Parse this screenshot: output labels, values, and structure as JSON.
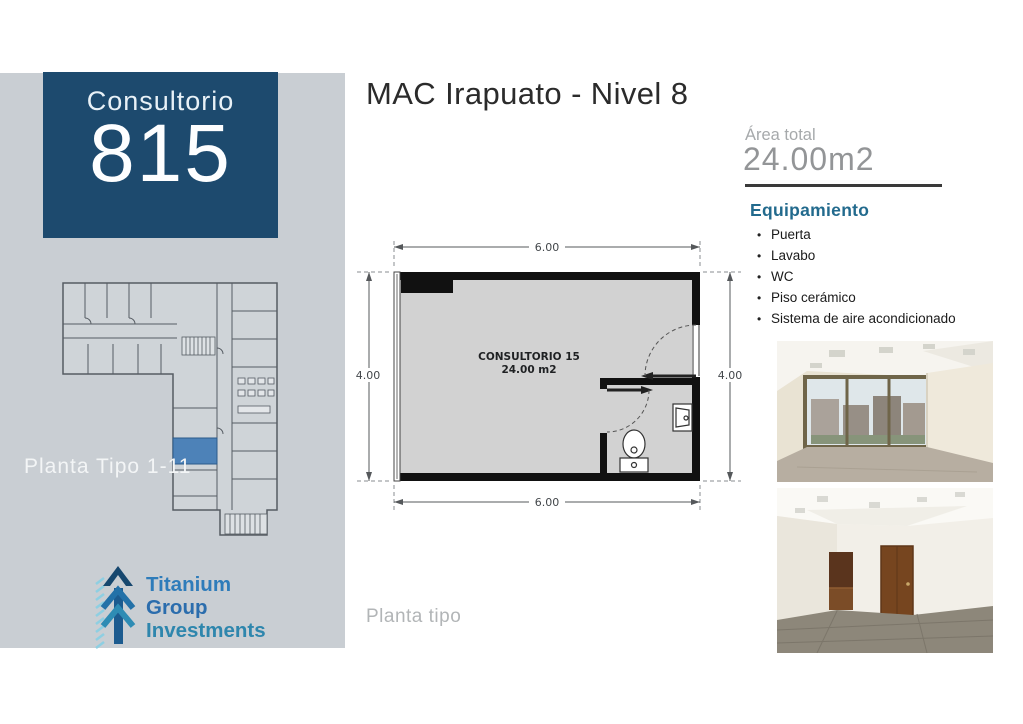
{
  "sidebar": {
    "bg_color": "#c9ced3",
    "unit_box": {
      "bg_color": "#1d4a6e",
      "label": "Consultorio",
      "number": "815"
    },
    "thumbnail": {
      "caption": "Planta Tipo 1-11",
      "highlight_room_color": "#4d82b8"
    },
    "logo": {
      "words": [
        "Titanium",
        "Group",
        "Investments"
      ],
      "colors": [
        "#2e7cba",
        "#2b6dad",
        "#2e86ad"
      ]
    }
  },
  "header": {
    "title": "MAC Irapuato - Nivel 8"
  },
  "floorplan": {
    "room_label": "CONSULTORIO 15",
    "room_area": "24.00 m2",
    "dimensions": {
      "top": "6.00",
      "bottom": "6.00",
      "left": "4.00",
      "right": "4.00"
    },
    "caption": "Planta tipo",
    "wall_color": "#111111",
    "floor_color": "#d2d2d2"
  },
  "details": {
    "area": {
      "label": "Área total",
      "value": "24.00m2"
    },
    "equipment": {
      "title": "Equipamiento",
      "items": [
        "Puerta",
        "Lavabo",
        "WC",
        "Piso cerámico",
        "Sistema de aire acondicionado"
      ]
    },
    "photos": [
      {
        "name": "office-with-window-photo"
      },
      {
        "name": "office-with-doors-photo"
      }
    ]
  }
}
